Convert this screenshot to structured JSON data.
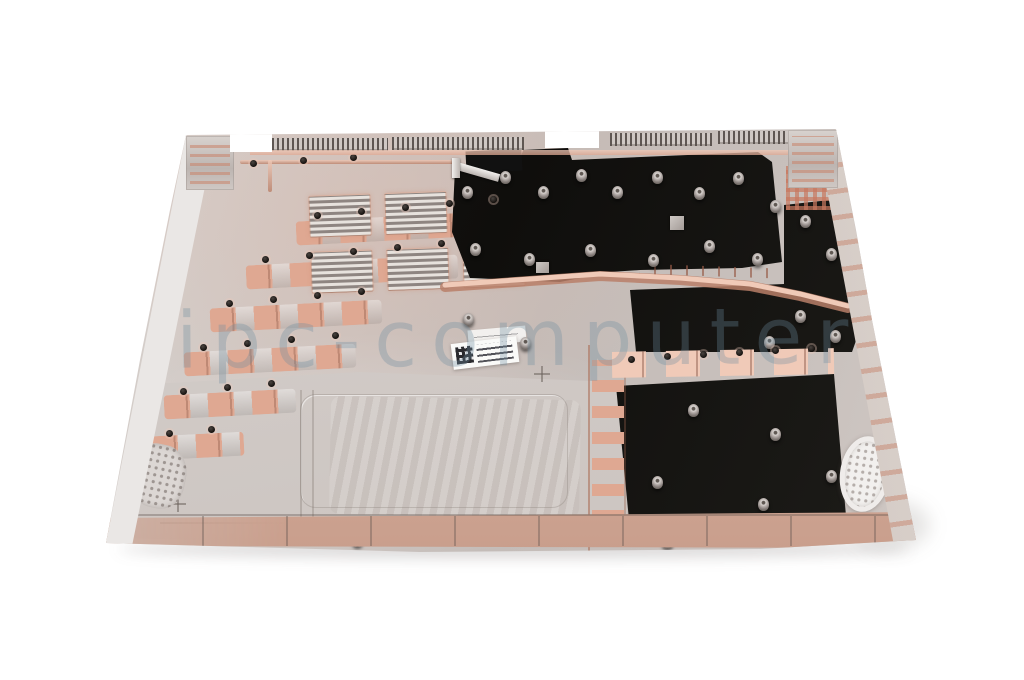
{
  "watermark": {
    "text": "ipc-computer"
  },
  "colors": {
    "background": "#ffffff",
    "silver": "#cbc4c0",
    "silver_light": "#ddd8d4",
    "silver_dark": "#aba39f",
    "wall": "#eae7e5",
    "copper": "#dfa892",
    "copper_light": "#f0cab8",
    "copper_dark": "#b97f68",
    "mylar": "#14120f",
    "grille": "#f2f0ee",
    "sticker": "#fafaf8",
    "watermark": "rgba(110,140,158,0.32)"
  },
  "details": {
    "screw_bosses": [
      [
        462,
        186
      ],
      [
        500,
        171
      ],
      [
        538,
        186
      ],
      [
        576,
        169
      ],
      [
        612,
        186
      ],
      [
        652,
        171
      ],
      [
        694,
        187
      ],
      [
        733,
        172
      ],
      [
        470,
        243
      ],
      [
        524,
        253
      ],
      [
        585,
        244
      ],
      [
        648,
        254
      ],
      [
        704,
        240
      ],
      [
        752,
        253
      ],
      [
        770,
        200
      ],
      [
        800,
        215
      ],
      [
        826,
        248
      ],
      [
        795,
        310
      ],
      [
        830,
        330
      ],
      [
        764,
        336
      ],
      [
        688,
        404
      ],
      [
        770,
        428
      ],
      [
        652,
        476
      ],
      [
        758,
        498
      ],
      [
        826,
        470
      ],
      [
        463,
        313
      ],
      [
        520,
        337
      ],
      [
        352,
        534
      ],
      [
        662,
        536
      ]
    ],
    "screw_holes": [
      [
        314,
        212
      ],
      [
        358,
        208
      ],
      [
        402,
        204
      ],
      [
        446,
        200
      ],
      [
        490,
        196
      ],
      [
        262,
        256
      ],
      [
        306,
        252
      ],
      [
        350,
        248
      ],
      [
        394,
        244
      ],
      [
        438,
        240
      ],
      [
        226,
        300
      ],
      [
        270,
        296
      ],
      [
        314,
        292
      ],
      [
        358,
        288
      ],
      [
        200,
        344
      ],
      [
        244,
        340
      ],
      [
        288,
        336
      ],
      [
        332,
        332
      ],
      [
        180,
        388
      ],
      [
        224,
        384
      ],
      [
        268,
        380
      ],
      [
        166,
        430
      ],
      [
        208,
        426
      ],
      [
        628,
        356
      ],
      [
        664,
        353
      ],
      [
        700,
        351
      ],
      [
        736,
        349
      ],
      [
        772,
        347
      ],
      [
        808,
        345
      ],
      [
        250,
        160
      ],
      [
        300,
        157
      ],
      [
        350,
        154
      ]
    ]
  }
}
